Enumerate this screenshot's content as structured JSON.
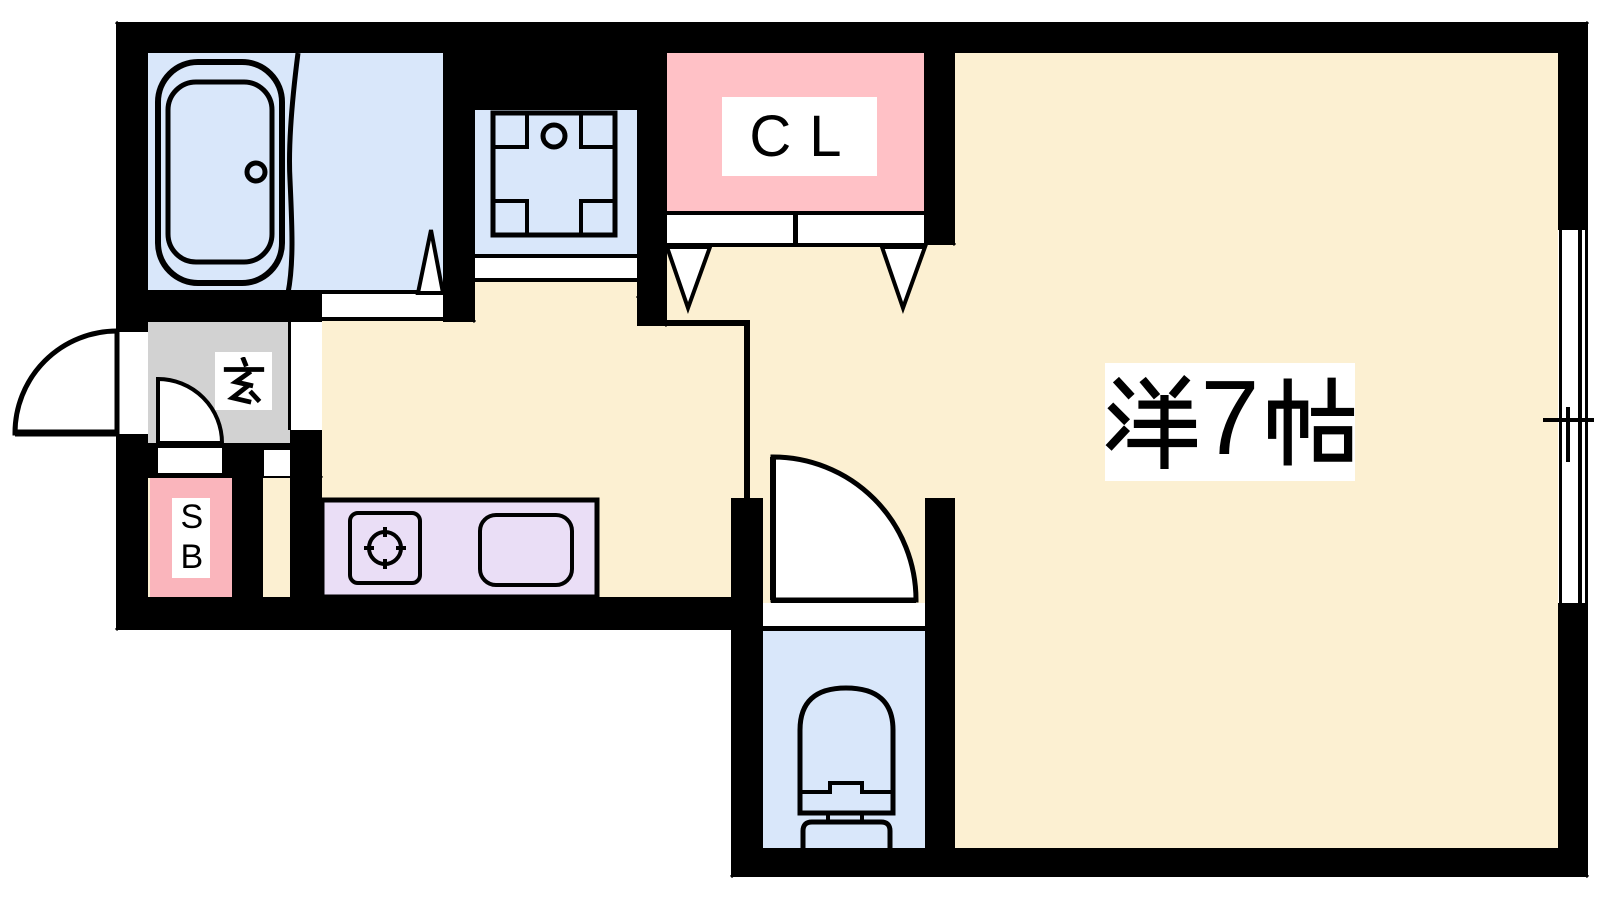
{
  "palette": {
    "bg": "#FFFFFF",
    "wall": "#000000",
    "floor": "#FCF0D2",
    "wet_area": "#D9E7FA",
    "closet_pink": "#FFC1C6",
    "shoebox_pink": "#FAB5BC",
    "genkan_gray": "#D2D2D2",
    "kitchen_purple": "#EADEF6",
    "label_bg": "#FFFFFF",
    "label_text": "#000000"
  },
  "labels": {
    "closet": "CL",
    "shoe_box": "SB",
    "genkan": "玄",
    "main_room": "洋7帖",
    "main_room_parts": {
      "kanji_left": "洋",
      "number": "7",
      "kanji_right": "帖"
    }
  },
  "icons": {
    "bathtub-icon": "rounded-rect tub with drain circle",
    "bath-partition-curve": "curved unit-bath divider",
    "washing-machine-pan-icon": "square pan with corner pads and faucet circle",
    "door-triangle-washroom": "door swing triangle",
    "folding-door-icons": "bi-fold closet door panels with V triangles",
    "entrance-door-arc": "outward quarter-circle door swing",
    "genkan-door-arc": "inner quarter-circle door swing",
    "toilet-door-arc": "quarter-circle door swing",
    "stove-icon": "burner circle with cross ticks in square",
    "sink-icon": "rounded rectangle sink",
    "toilet-icon": "toilet bowl with tank",
    "window-icon": "sliding window symbol in wall"
  }
}
